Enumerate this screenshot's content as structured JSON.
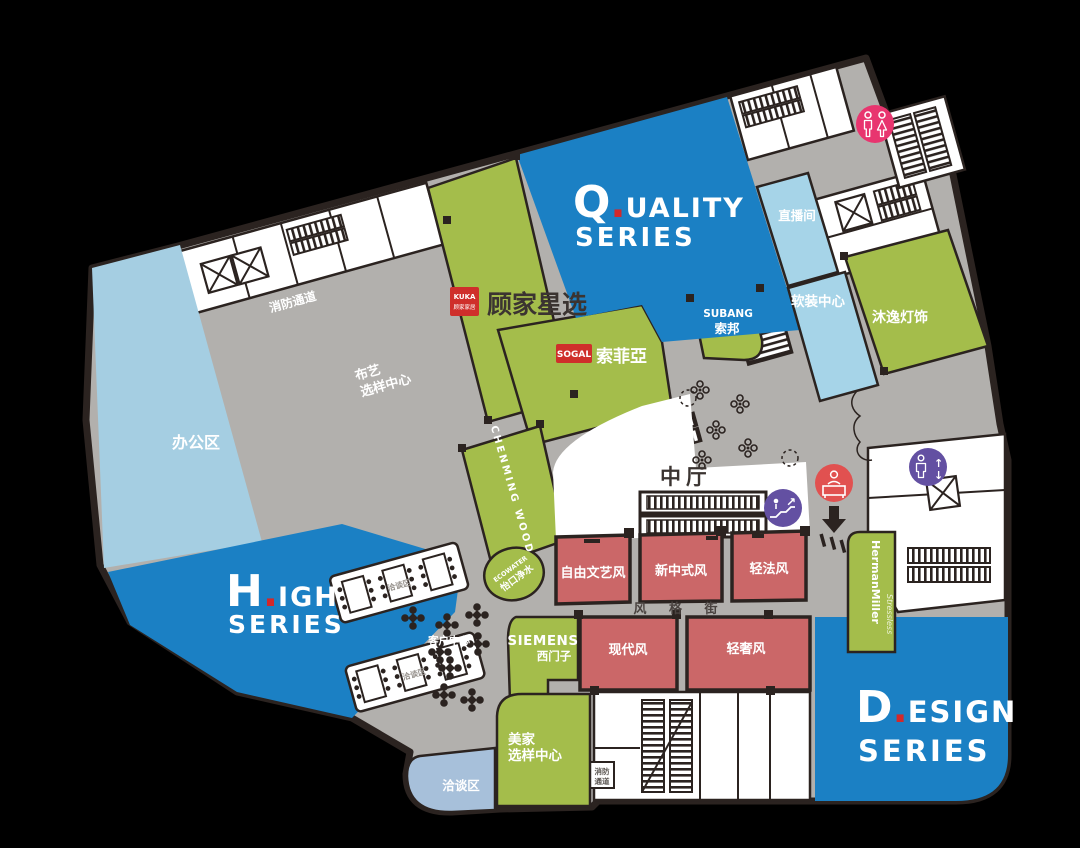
{
  "titles": {
    "quality": {
      "letter": "Q",
      "dot": ".",
      "rest": "UALITY",
      "line2": "SERIES"
    },
    "high": {
      "letter": "H",
      "dot": ".",
      "rest": "IGH",
      "line2": "SERIES"
    },
    "design": {
      "letter": "D",
      "dot": ".",
      "rest": "ESIGN",
      "line2": "SERIES"
    }
  },
  "areas": {
    "office": "办公区",
    "fire_passage_top": "消防通道",
    "fabric_center_line1": "布艺",
    "fabric_center_line2": "选样中心",
    "central_hall": "中厅",
    "live_stream_room": "直播间",
    "soft_deco_center": "软装中心",
    "style_street": "风 格 街",
    "client_center": "客户中心",
    "meeting_area_1": "洽谈区",
    "meeting_area_2": "洽谈区",
    "meeting_lounge": "洽谈区",
    "meijia_line1": "美家",
    "meijia_line2": "选样中心",
    "fire_bottom_line1": "消防",
    "fire_bottom_line2": "通道"
  },
  "style_rooms": [
    "自由文艺风",
    "新中式风",
    "轻法风",
    "现代风",
    "轻奢风"
  ],
  "brands": {
    "kuka_logo_top": "KUKA",
    "kuka_logo_bottom": "顾家家居",
    "kuka_store": "顾家星选",
    "sogal_logo": "SOGAL",
    "sogal_name": "索菲亞",
    "subang_en": "SUBANG",
    "subang_cn": "索邦",
    "muyi": "沐逸灯饰",
    "chenming": "CHENMING WOOD",
    "ecowater_en": "ECOWATER",
    "ecowater_cn": "怡口净水",
    "siemens_en": "SIEMENS",
    "siemens_cn": "西门子",
    "hermanmiller": "HermanMiller",
    "hermanmiller_sub": "Stressless"
  },
  "colors": {
    "series_blue": "#1b80c4",
    "zone_green": "#a4bd4b",
    "office_blue": "#a5cee2",
    "room_blue": "#a6d4e8",
    "lounge_blue": "#a7c0da",
    "floor_gray": "#b2b0ad",
    "style_room_red": "#cb6768",
    "outline_dark": "#2b2320",
    "restroom_pink": "#e8356f",
    "elevator_purple": "#6350a2",
    "reception_red": "#e15150",
    "logo_red": "#cf2f2b",
    "title_dot_red": "#d3282a"
  }
}
